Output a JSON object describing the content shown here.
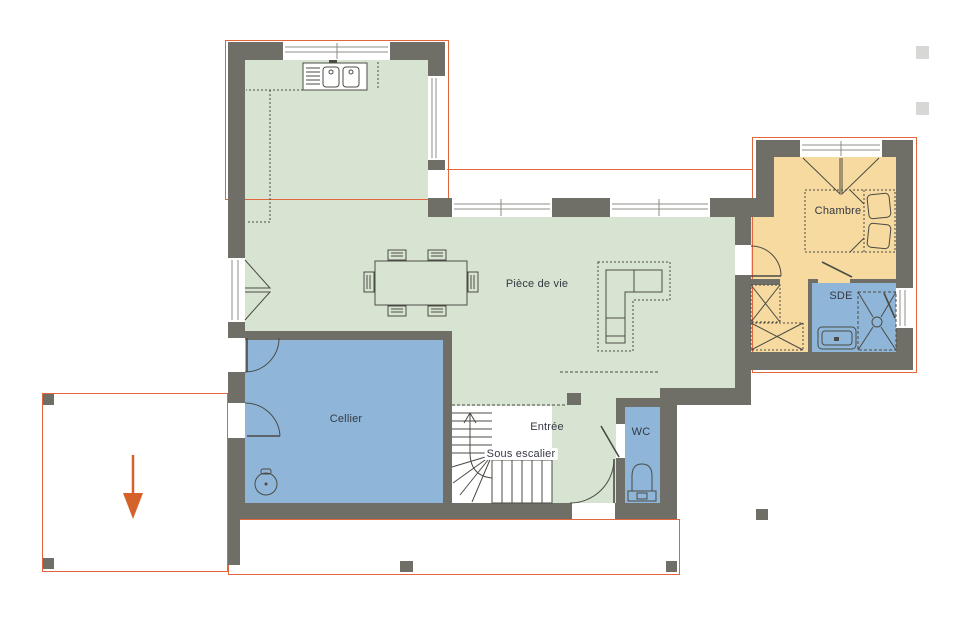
{
  "rooms": [
    {
      "id": "piece-de-vie",
      "label": "Pièce de vie"
    },
    {
      "id": "cellier",
      "label": "Cellier"
    },
    {
      "id": "entree",
      "label": "Entrée"
    },
    {
      "id": "sous-escalier",
      "label": "Sous escalier"
    },
    {
      "id": "wc",
      "label": "WC"
    },
    {
      "id": "chambre",
      "label": "Chambre"
    },
    {
      "id": "sde",
      "label": "SDE"
    }
  ],
  "colors": {
    "wall": "#6f6e67",
    "room-green": "#d8e4d2",
    "room-blue": "#8fb6d8",
    "room-yellow": "#f6daa0",
    "outline-orange": "#e2653c",
    "arrow-orange": "#d4622a",
    "line": "#4b4b45",
    "label": "#343842"
  },
  "fixtures": [
    "kitchen-sink",
    "kitchen-counter",
    "dining-table",
    "chairs",
    "corner-sofa",
    "double-bed",
    "wardrobe",
    "shower",
    "vanity-sink",
    "toilet",
    "water-heater",
    "staircase",
    "under-stairs-storage",
    "entrance-door",
    "french-window",
    "terrace",
    "carport",
    "driveway-arrow"
  ]
}
